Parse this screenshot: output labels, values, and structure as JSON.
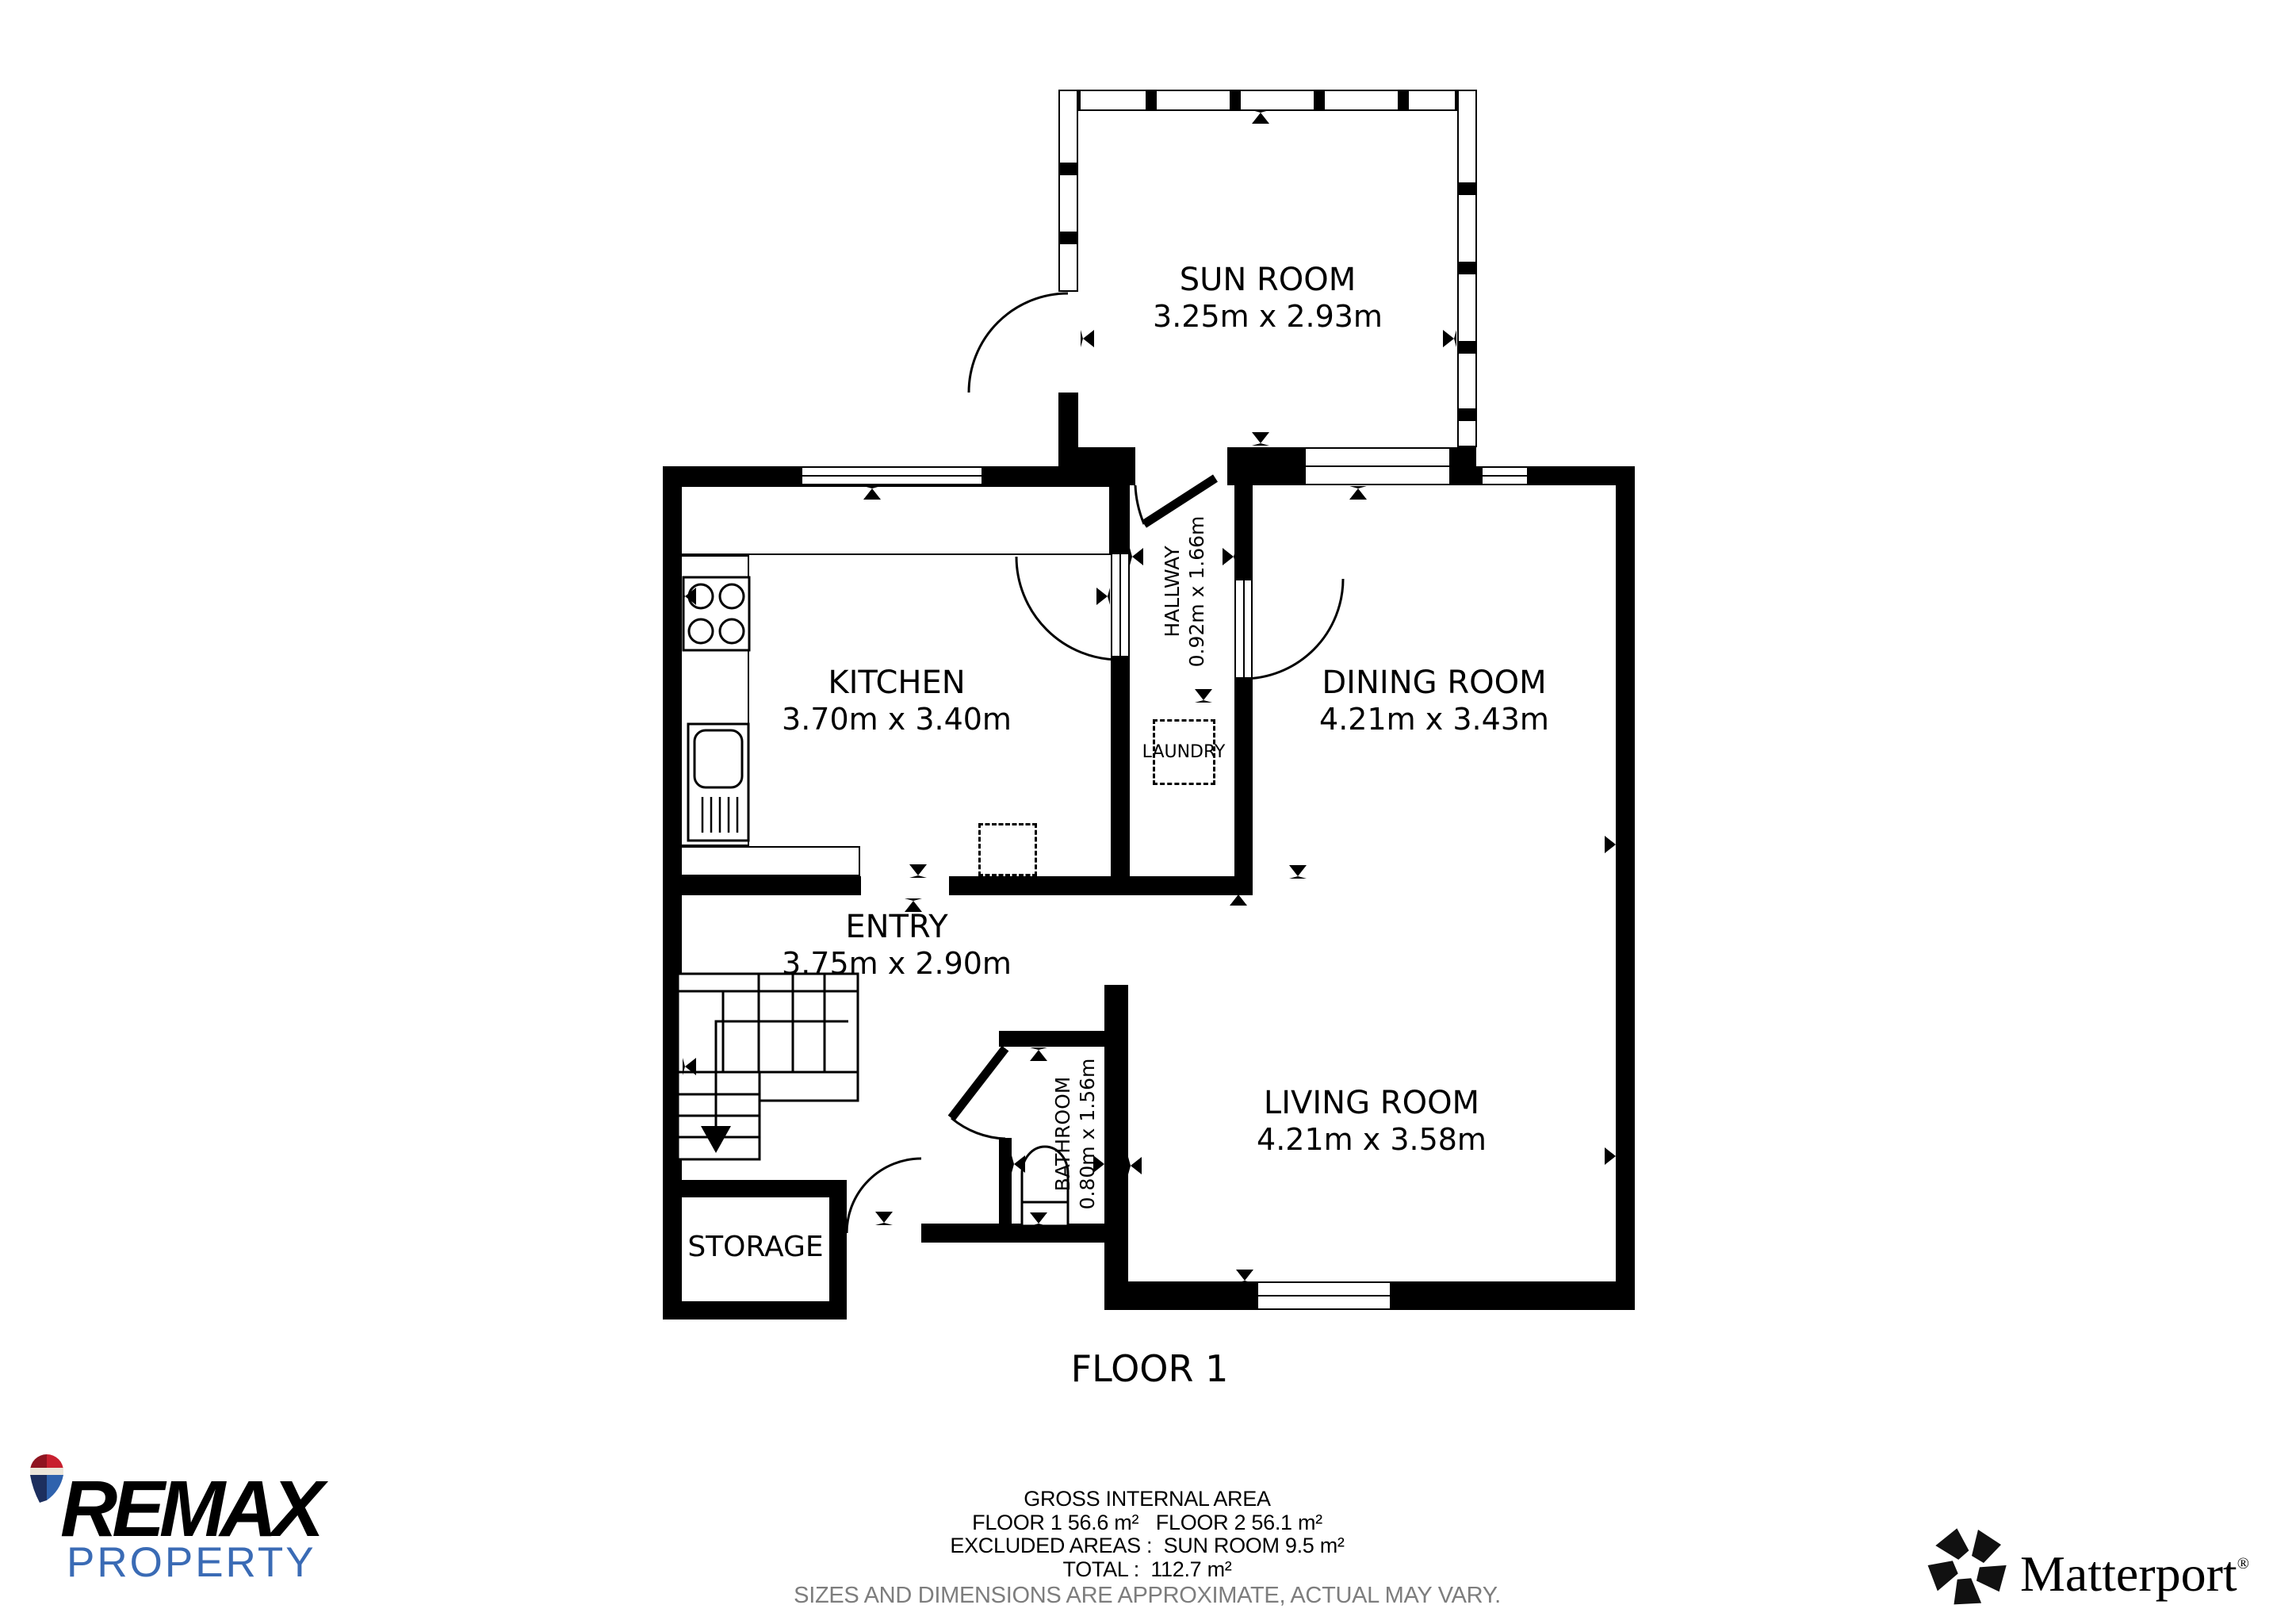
{
  "plan": {
    "floor_label": "FLOOR 1",
    "rooms": [
      {
        "id": "sun-room",
        "name": "SUN ROOM",
        "dims": "3.25m x 2.93m"
      },
      {
        "id": "kitchen",
        "name": "KITCHEN",
        "dims": "3.70m x 3.40m"
      },
      {
        "id": "dining-room",
        "name": "DINING ROOM",
        "dims": "4.21m x 3.43m"
      },
      {
        "id": "entry",
        "name": "ENTRY",
        "dims": "3.75m x 2.90m"
      },
      {
        "id": "living-room",
        "name": "LIVING ROOM",
        "dims": "4.21m x 3.58m"
      },
      {
        "id": "storage",
        "name": "STORAGE",
        "dims": ""
      },
      {
        "id": "hallway",
        "name": "HALLWAY",
        "dims": "0.92m x 1.66m"
      },
      {
        "id": "bathroom",
        "name": "BATHROOM",
        "dims": "0.80m x 1.56m"
      },
      {
        "id": "laundry",
        "name": "LAUNDRY",
        "dims": ""
      }
    ]
  },
  "footer": {
    "area_title": "GROSS INTERNAL AREA",
    "floors_line": "FLOOR 1 56.6 m²   FLOOR 2 56.1 m²",
    "excluded_line": "EXCLUDED AREAS :  SUN ROOM 9.5 m²",
    "total_line": "TOTAL :  112.7 m²",
    "disclaimer": "SIZES AND DIMENSIONS ARE APPROXIMATE, ACTUAL MAY VARY."
  },
  "branding": {
    "remax": {
      "name": "REMAX",
      "tagline": "PROPERTY"
    },
    "matterport": {
      "name": "Matterport",
      "registered": "®"
    }
  },
  "colors": {
    "wall": "#000000",
    "background": "#ffffff",
    "remax_blue": "#3a6bb5",
    "balloon_red": "#c8202f",
    "balloon_dark_red": "#8f1420",
    "balloon_cream": "#ece6da",
    "balloon_navy": "#1d2f5e",
    "balloon_blue": "#2f62ad",
    "disclaimer_gray": "#7d7d7d"
  }
}
